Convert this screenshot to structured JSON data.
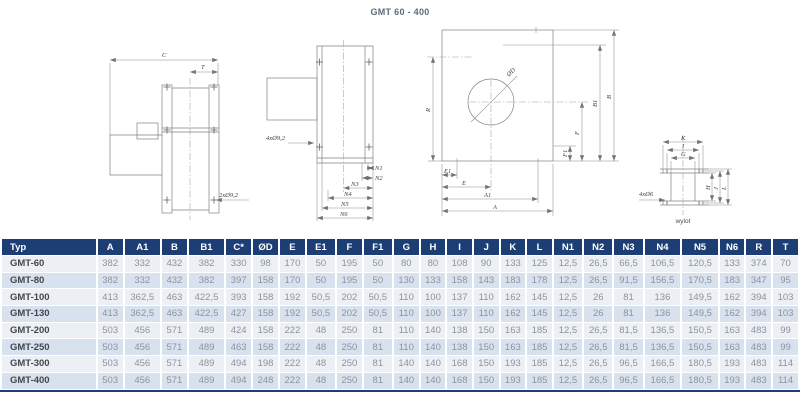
{
  "title": "GMT 60 - 400",
  "colors": {
    "navy": "#1c3e74",
    "row_light": "#ecf0f5",
    "row_dark": "#d8e2ee",
    "typ_text": "#42474e",
    "value_text": "#8c939c",
    "title_text": "#5b6b7d",
    "line": "#7d8288"
  },
  "drawings": {
    "side": {
      "c": "C",
      "t": "T",
      "holes": "2xØ9,2"
    },
    "front": {
      "holes": "4xØ9,2",
      "n1": "N1",
      "n2": "N2",
      "n3": "N3",
      "n4": "N4",
      "n5": "N5",
      "n6": "N6"
    },
    "plate": {
      "d": "ØD",
      "r": "R",
      "f1": "F1",
      "f": "F",
      "b1": "B1",
      "b": "B",
      "e1": "E1",
      "e": "E",
      "a1": "A1",
      "a": "A"
    },
    "outlet": {
      "k": "K",
      "i": "I",
      "g": "G",
      "h": "H",
      "j": "J",
      "l": "L",
      "holes": "4xØ6",
      "caption": "wylot"
    }
  },
  "table": {
    "columns": [
      "Typ",
      "A",
      "A1",
      "B",
      "B1",
      "C*",
      "ØD",
      "E",
      "E1",
      "F",
      "F1",
      "G",
      "H",
      "I",
      "J",
      "K",
      "L",
      "N1",
      "N2",
      "N3",
      "N4",
      "N5",
      "N6",
      "R",
      "T"
    ],
    "rows": [
      {
        "typ": "GMT-60",
        "values": [
          "382",
          "332",
          "432",
          "382",
          "330",
          "98",
          "170",
          "50",
          "195",
          "50",
          "80",
          "80",
          "108",
          "90",
          "133",
          "125",
          "12,5",
          "26,5",
          "66,5",
          "106,5",
          "120,5",
          "133",
          "374",
          "70"
        ]
      },
      {
        "typ": "GMT-80",
        "values": [
          "382",
          "332",
          "432",
          "382",
          "397",
          "158",
          "170",
          "50",
          "195",
          "50",
          "130",
          "133",
          "158",
          "143",
          "183",
          "178",
          "12,5",
          "26,5",
          "91,5",
          "156,5",
          "170,5",
          "183",
          "347",
          "95"
        ]
      },
      {
        "typ": "GMT-100",
        "values": [
          "413",
          "362,5",
          "463",
          "422,5",
          "393",
          "158",
          "192",
          "50,5",
          "202",
          "50,5",
          "110",
          "100",
          "137",
          "110",
          "162",
          "145",
          "12,5",
          "26",
          "81",
          "136",
          "149,5",
          "162",
          "394",
          "103"
        ]
      },
      {
        "typ": "GMT-130",
        "values": [
          "413",
          "362,5",
          "463",
          "422,5",
          "427",
          "158",
          "192",
          "50,5",
          "202",
          "50,5",
          "110",
          "100",
          "137",
          "110",
          "162",
          "145",
          "12,5",
          "26",
          "81",
          "136",
          "149,5",
          "162",
          "394",
          "103"
        ]
      },
      {
        "typ": "GMT-200",
        "values": [
          "503",
          "456",
          "571",
          "489",
          "424",
          "158",
          "222",
          "48",
          "250",
          "81",
          "110",
          "140",
          "138",
          "150",
          "163",
          "185",
          "12,5",
          "26,5",
          "81,5",
          "136,5",
          "150,5",
          "163",
          "483",
          "99"
        ]
      },
      {
        "typ": "GMT-250",
        "values": [
          "503",
          "456",
          "571",
          "489",
          "463",
          "158",
          "222",
          "48",
          "250",
          "81",
          "110",
          "140",
          "138",
          "150",
          "163",
          "185",
          "12,5",
          "26,5",
          "81,5",
          "136,5",
          "150,5",
          "163",
          "483",
          "99"
        ]
      },
      {
        "typ": "GMT-300",
        "values": [
          "503",
          "456",
          "571",
          "489",
          "494",
          "198",
          "222",
          "48",
          "250",
          "81",
          "140",
          "140",
          "168",
          "150",
          "193",
          "185",
          "12,5",
          "26,5",
          "96,5",
          "166,5",
          "180,5",
          "193",
          "483",
          "114"
        ]
      },
      {
        "typ": "GMT-400",
        "values": [
          "503",
          "456",
          "571",
          "489",
          "494",
          "248",
          "222",
          "48",
          "250",
          "81",
          "140",
          "140",
          "168",
          "150",
          "193",
          "185",
          "12,5",
          "26,5",
          "96,5",
          "166,5",
          "180,5",
          "193",
          "483",
          "114"
        ]
      }
    ]
  }
}
